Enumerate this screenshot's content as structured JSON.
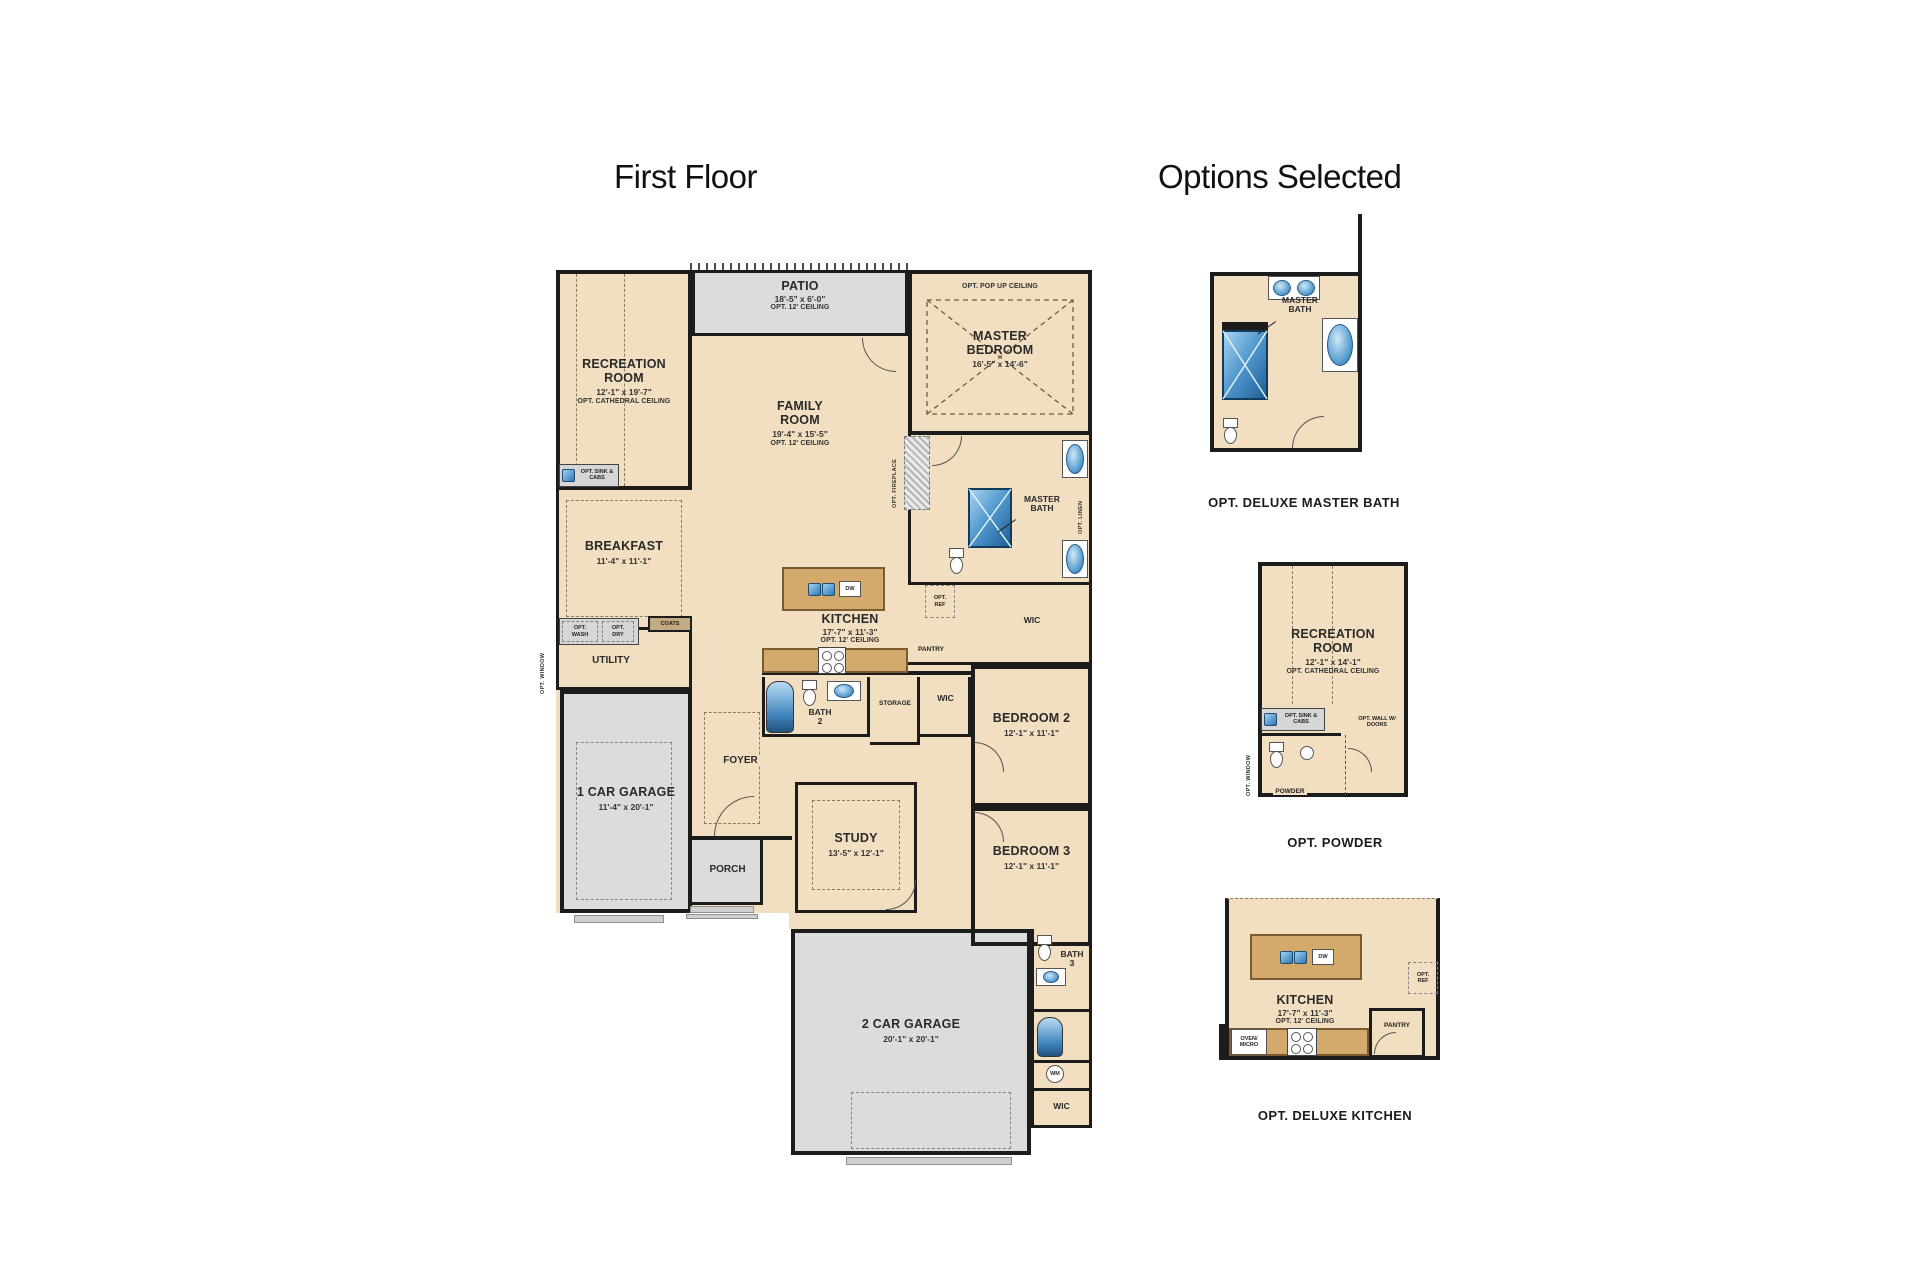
{
  "titles": {
    "first_floor": "First Floor",
    "options_selected": "Options Selected"
  },
  "colors": {
    "room_fill": "#f2dfc1",
    "outdoor_fill": "#dcdcdc",
    "wood": "#d3a96c",
    "wall": "#1c1c1c",
    "fixture_blue": "#2f78b4"
  },
  "plan": {
    "recreation_room": {
      "name": "RECREATION ROOM",
      "dims": "12'-1\" x 19'-7\"",
      "note": "OPT. CATHEDRAL CEILING"
    },
    "patio": {
      "name": "PATIO",
      "dims": "18'-5\" x 6'-0\"",
      "note": "OPT. 12' CEILING"
    },
    "master_bedroom": {
      "name": "MASTER BEDROOM",
      "dims": "16'-5\" x 14'-6\"",
      "ceiling": "OPT. POP UP CEILING"
    },
    "family_room": {
      "name": "FAMILY ROOM",
      "dims": "19'-4\" x 15'-5\"",
      "note": "OPT. 12' CEILING"
    },
    "breakfast": {
      "name": "BREAKFAST",
      "dims": "11'-4\" x 11'-1\""
    },
    "kitchen": {
      "name": "KITCHEN",
      "dims": "17'-7\" x 11'-3\"",
      "note": "OPT. 12' CEILING"
    },
    "master_bath": {
      "name": "MASTER BATH"
    },
    "master_wic": {
      "name": "WIC"
    },
    "utility": {
      "name": "UTILITY"
    },
    "coats": {
      "name": "COATS"
    },
    "garage_1": {
      "name": "1 CAR GARAGE",
      "dims": "11'-4\" x 20'-1\""
    },
    "foyer": {
      "name": "FOYER"
    },
    "porch": {
      "name": "PORCH"
    },
    "bath_2": {
      "name": "BATH 2"
    },
    "storage": {
      "name": "STORAGE"
    },
    "wic_2": {
      "name": "WIC"
    },
    "bedroom_2": {
      "name": "BEDROOM 2",
      "dims": "12'-1\" x 11'-1\""
    },
    "study": {
      "name": "STUDY",
      "dims": "13'-5\" x 12'-1\""
    },
    "bedroom_3": {
      "name": "BEDROOM 3",
      "dims": "12'-1\" x 11'-1\""
    },
    "bath_3": {
      "name": "BATH 3"
    },
    "garage_2": {
      "name": "2 CAR GARAGE",
      "dims": "20'-1\" x 20'-1\""
    },
    "wic_3": {
      "name": "WIC"
    },
    "ann": {
      "opt_fireplace": "OPT. FIREPLACE",
      "opt_sink_cabs": "OPT. SINK & CABS",
      "opt_wash": "OPT. WASH",
      "opt_dry": "OPT. DRY",
      "opt_window": "OPT. WINDOW",
      "opt_ref": "OPT. REF",
      "opt_linen": "OPT. LINEN",
      "pantry": "PANTRY",
      "dw": "DW",
      "wm": "WM"
    }
  },
  "options": {
    "deluxe_master_bath": {
      "caption": "OPT. DELUXE MASTER BATH",
      "room": "MASTER BATH"
    },
    "powder": {
      "caption": "OPT. POWDER",
      "room": {
        "name": "RECREATION ROOM",
        "dims": "12'-1\" x 14'-1\"",
        "note": "OPT. CATHEDRAL CEILING"
      },
      "opt_sink_cabs": "OPT. SINK & CABS",
      "opt_wall": "OPT. WALL W/ DOORS",
      "powder_label": "POWDER",
      "opt_window": "OPT. WINDOW"
    },
    "deluxe_kitchen": {
      "caption": "OPT. DELUXE KITCHEN",
      "room": {
        "name": "KITCHEN",
        "dims": "17'-7\" x 11'-3\"",
        "note": "OPT. 12' CEILING"
      },
      "oven_micro": "OVEN/ MICRO",
      "pantry": "PANTRY",
      "opt_ref": "OPT. REF",
      "dw": "DW"
    }
  }
}
